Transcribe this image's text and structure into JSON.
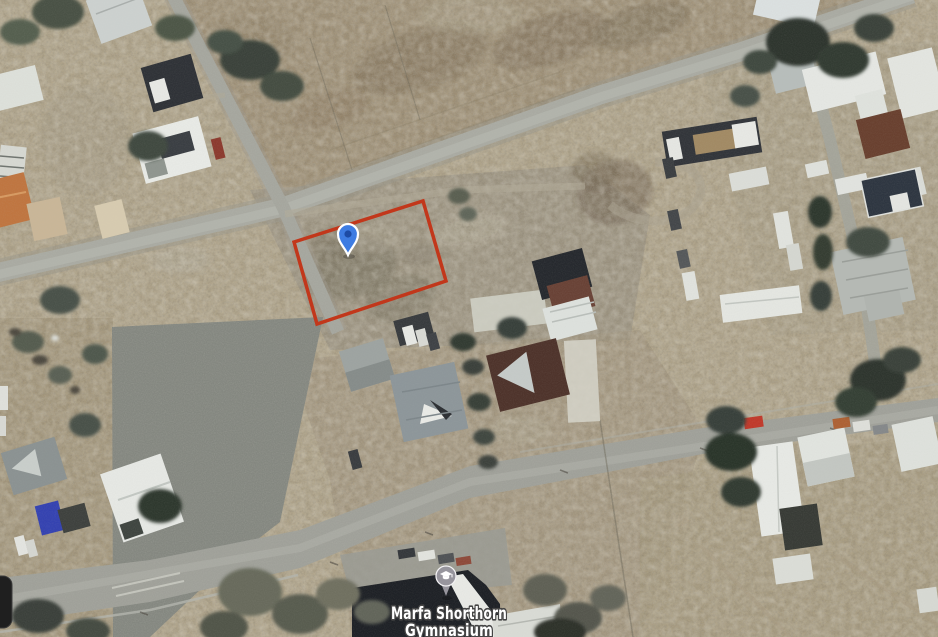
{
  "map": {
    "view_type": "satellite-aerial",
    "labels": {
      "poi_line1": "Marfa Shorthorn",
      "poi_line2": "Gymnasium"
    },
    "markers": [
      {
        "id": "selected-location",
        "icon": "map-pin-icon",
        "fill": "#3e7ce2",
        "inner_dot": "#1d4ba5",
        "outline": "#ffffff",
        "position": {
          "x": 348,
          "y": 234
        }
      },
      {
        "id": "school-poi",
        "icon": "graduation-cap-icon",
        "fill": "#97959d",
        "glyph_color": "#ffffff",
        "position": {
          "x": 446,
          "y": 576
        }
      }
    ],
    "parcel": {
      "outline_color": "#c2371b",
      "corners": [
        [
          294,
          242
        ],
        [
          423,
          201
        ],
        [
          446,
          281
        ],
        [
          317,
          324
        ]
      ]
    },
    "palette": {
      "dirt": "#afa389",
      "field_brown": "#9b8c72",
      "road_gray": "#a9aaa2",
      "paved_apron": "#848780",
      "tree_dark": "#333a33",
      "roof_white": "#e8eae6",
      "roof_dark": "#2f3237",
      "label_fill": "#ffffff",
      "label_halo": "#454545"
    }
  }
}
